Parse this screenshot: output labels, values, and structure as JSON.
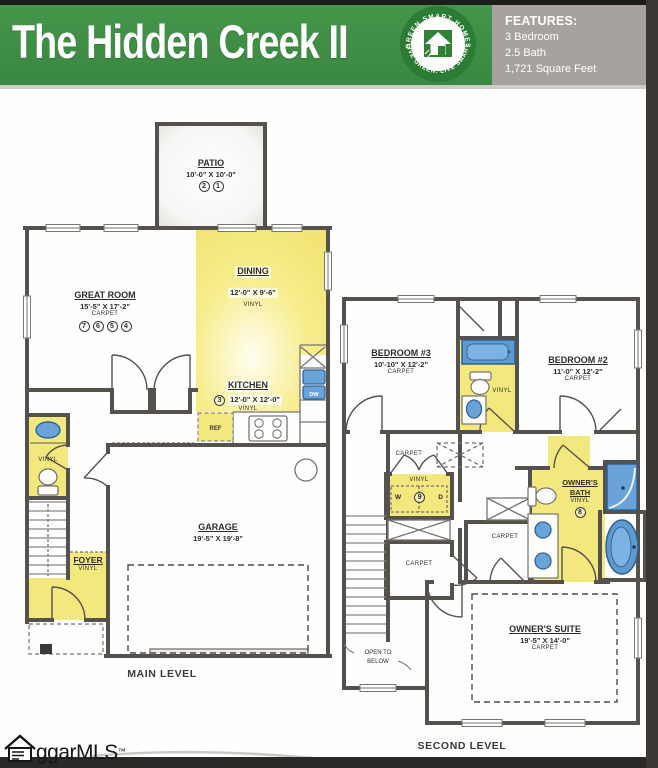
{
  "header": {
    "title": "The Hidden Creek II",
    "logo": {
      "arc_top": "GREEN SMART HOMES",
      "arc_bottom": "LIVE GREEN. LIVE SMART"
    },
    "features": {
      "heading": "FEATURES:",
      "items": [
        "3 Bedroom",
        "2.5 Bath",
        "1,721 Square Feet"
      ]
    }
  },
  "main_level": {
    "caption": "MAIN LEVEL",
    "patio": {
      "name": "PATIO",
      "dims": "10'-0\" X 10'-0\"",
      "markers": [
        "2",
        "1"
      ]
    },
    "great_room": {
      "name": "GREAT ROOM",
      "dims": "15'-5\" X 17'-2\"",
      "floor": "CARPET",
      "markers": [
        "7",
        "6",
        "5",
        "4"
      ]
    },
    "dining": {
      "name": "DINING",
      "dims": "12'-0\" X 9'-6\"",
      "floor": "VINYL"
    },
    "kitchen": {
      "name": "KITCHEN",
      "marker": "3",
      "dims": "12'-0\" X 12'-0\"",
      "floor": "VINYL",
      "ref": "REF",
      "dw": "DW"
    },
    "powder": {
      "floor": "VINYL"
    },
    "foyer": {
      "name": "FOYER",
      "floor": "VINYL"
    },
    "garage": {
      "name": "GARAGE",
      "dims": "19'-5\" X 19'-8\""
    }
  },
  "second_level": {
    "caption": "SECOND LEVEL",
    "bedroom3": {
      "name": "BEDROOM #3",
      "dims": "10'-10\" X 12'-2\"",
      "floor": "CARPET"
    },
    "bedroom2": {
      "name": "BEDROOM #2",
      "dims": "11'-0\" X 12'-2\"",
      "floor": "CARPET"
    },
    "hall_bath": {
      "floor": "VINYL"
    },
    "hall": {
      "floor": "CARPET"
    },
    "laundry": {
      "floor": "VINYL",
      "washer": "W",
      "dryer": "D",
      "marker": "9"
    },
    "closet_hall": {
      "floor": "CARPET"
    },
    "closet_owner": {
      "floor": "CARPET"
    },
    "owners_bath": {
      "name_line1": "OWNER'S",
      "name_line2": "BATH",
      "floor": "VINYL",
      "marker": "8"
    },
    "owners_suite": {
      "name": "OWNER'S SUITE",
      "dims": "19'-5\" X 14'-0\"",
      "floor": "CARPET"
    },
    "open_to_below": {
      "line1": "OPEN TO",
      "line2": "BELOW"
    }
  },
  "footer": {
    "brand": "ggarMLS",
    "tm": "™"
  },
  "colors": {
    "banner_green": "#3f8e47",
    "features_gray": "#a8a29f",
    "floor_yellow": "#f3e87d",
    "fixture_blue": "#6aa3d8",
    "wall_gray": "#55514d"
  }
}
